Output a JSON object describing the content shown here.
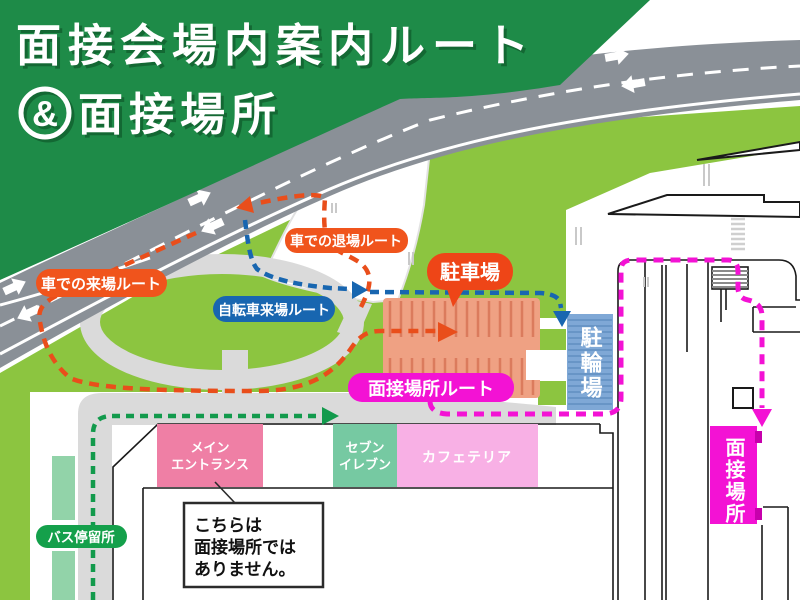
{
  "title": {
    "line1": "面接会場内案内ルート",
    "ampersand": "&",
    "line2": "面接場所"
  },
  "route_labels": {
    "car_arrival": "車での来場ルート",
    "car_exit": "車での退場ルート",
    "bicycle": "自転車来場ルート",
    "interview_route": "面接場所ルート"
  },
  "place_labels": {
    "parking": "駐車場",
    "bicycle_parking": "駐輪場",
    "main_entrance_line1": "メイン",
    "main_entrance_line2": "エントランス",
    "seven_eleven_line1": "セブン",
    "seven_eleven_line2": "イレブン",
    "cafeteria": "カフェテリア",
    "bus_stop": "バス停留所",
    "interview_place": "面接場所"
  },
  "callout": {
    "line1": "こちらは",
    "line2": "面接場所では",
    "line3": "ありません。"
  },
  "colors": {
    "title_green": "#1E8B48",
    "lawn_green": "#8CC540",
    "road_gray": "#8A9097",
    "path_gray": "#DADADA",
    "route_orange": "#E94E1B",
    "label_orange": "#F0541C",
    "parking_bubble": "#EE4517",
    "route_blue": "#1866B0",
    "route_green": "#129A4C",
    "route_magenta": "#F312D4",
    "parking_fill": "#EFA183",
    "parking_stripe": "#DB7B5D",
    "bike_area_fill": "#7FA8D6",
    "bike_area_stripe": "#6895C6",
    "mint_strip": "#92D3A9",
    "facade_pink": "#EF7FA5",
    "facade_mint": "#76C9A2",
    "facade_lightpink": "#F8B0E5"
  }
}
